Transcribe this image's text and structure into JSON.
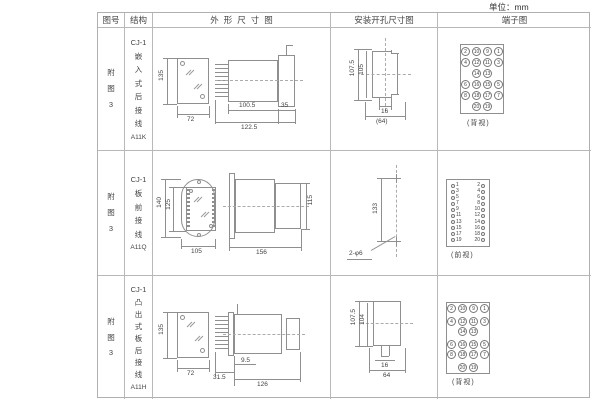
{
  "unit_label": "单位：mm",
  "table": {
    "headers": {
      "fig_no": "图号",
      "structure": "结构",
      "outline": "外形尺寸图",
      "install": "安装开孔尺寸图",
      "terminal": "端子图"
    },
    "rows": [
      {
        "fig_no": "附图3",
        "structure": {
          "model": "CJ-1",
          "desc": "嵌入式后接线",
          "code": "A11K"
        },
        "outline_dims": {
          "height": "135",
          "width": "72",
          "body_depth": "100.5",
          "total_depth": "122.5",
          "flange_depth": "35"
        },
        "install_dims": {
          "outer_height": "107.5",
          "inner_height": "105",
          "inner_width": "16",
          "outer_width": "(64)"
        },
        "terminal": {
          "view_label": "(背视)",
          "rows": [
            [
              2,
              10,
              9,
              1
            ],
            [
              4,
              12,
              11,
              3
            ],
            [
              14,
              13
            ],
            [
              6,
              16,
              15,
              5
            ],
            [
              8,
              18,
              17,
              7
            ],
            [
              20,
              19
            ]
          ]
        }
      },
      {
        "fig_no": "附图3",
        "structure": {
          "model": "CJ-1",
          "desc": "板前接线",
          "code": "A11Q"
        },
        "outline_dims": {
          "outer_height": "140",
          "inner_height": "125",
          "width": "105",
          "depth": "156",
          "side_height": "115"
        },
        "install_dims": {
          "hole_spacing": "133",
          "holes_label": "2-φ6"
        },
        "terminal": {
          "view_label": "(前视)",
          "left": [
            1,
            3,
            5,
            7,
            9,
            11,
            13,
            15,
            17,
            19
          ],
          "right": [
            2,
            4,
            6,
            8,
            10,
            12,
            14,
            16,
            18,
            20
          ]
        }
      },
      {
        "fig_no": "附图3",
        "structure": {
          "model": "CJ-1",
          "desc": "凸出式板后接线",
          "code": "A11H"
        },
        "outline_dims": {
          "height": "135",
          "width": "72",
          "flange_depth": "31.5",
          "stud_depth": "9.5",
          "body_depth": "126"
        },
        "install_dims": {
          "outer_height": "107.5",
          "inner_height": "104",
          "inner_width": "16",
          "outer_width": "64"
        },
        "terminal": {
          "view_label": "(背视)",
          "rows": [
            [
              2,
              10,
              9,
              1
            ],
            [
              4,
              12,
              11,
              3
            ],
            [
              14,
              13
            ],
            [
              6,
              16,
              15,
              5
            ],
            [
              8,
              18,
              17,
              7
            ],
            [
              20,
              19
            ]
          ]
        }
      }
    ]
  }
}
